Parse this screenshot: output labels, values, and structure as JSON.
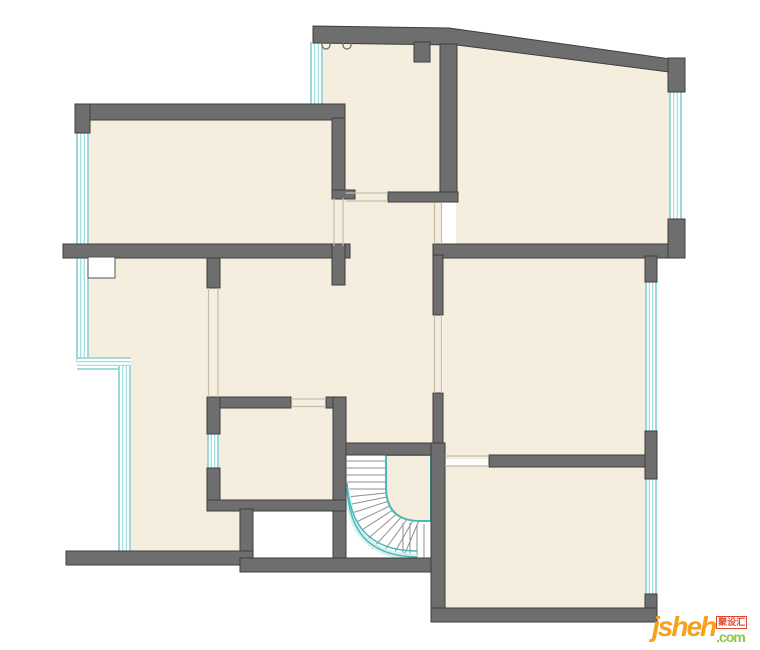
{
  "page": {
    "title": "residential floor plan drawing",
    "type": "architectural-plan"
  },
  "watermark": {
    "brand": "jsheh",
    "cn": "聚设汇",
    "tld": ".com"
  },
  "colors": {
    "wall": "#6e6e6e",
    "wall_outline": "#3d3d3d",
    "floor": "#f5edde",
    "background": "#ffffff",
    "teal": "#49b8b8",
    "teal_light": "#d6efef",
    "logo_orange": "#F7A01A",
    "logo_green": "#8CC63E",
    "logo_red": "#E0492F"
  },
  "plan_features": {
    "rooms_visible": 8,
    "staircase": "quarter-turn curved stair, lower center",
    "window_symbol": "parallel teal lines on exterior walls",
    "door_symbol": "thin jamb lines across wall gaps",
    "ceiling_fixtures": 2
  }
}
